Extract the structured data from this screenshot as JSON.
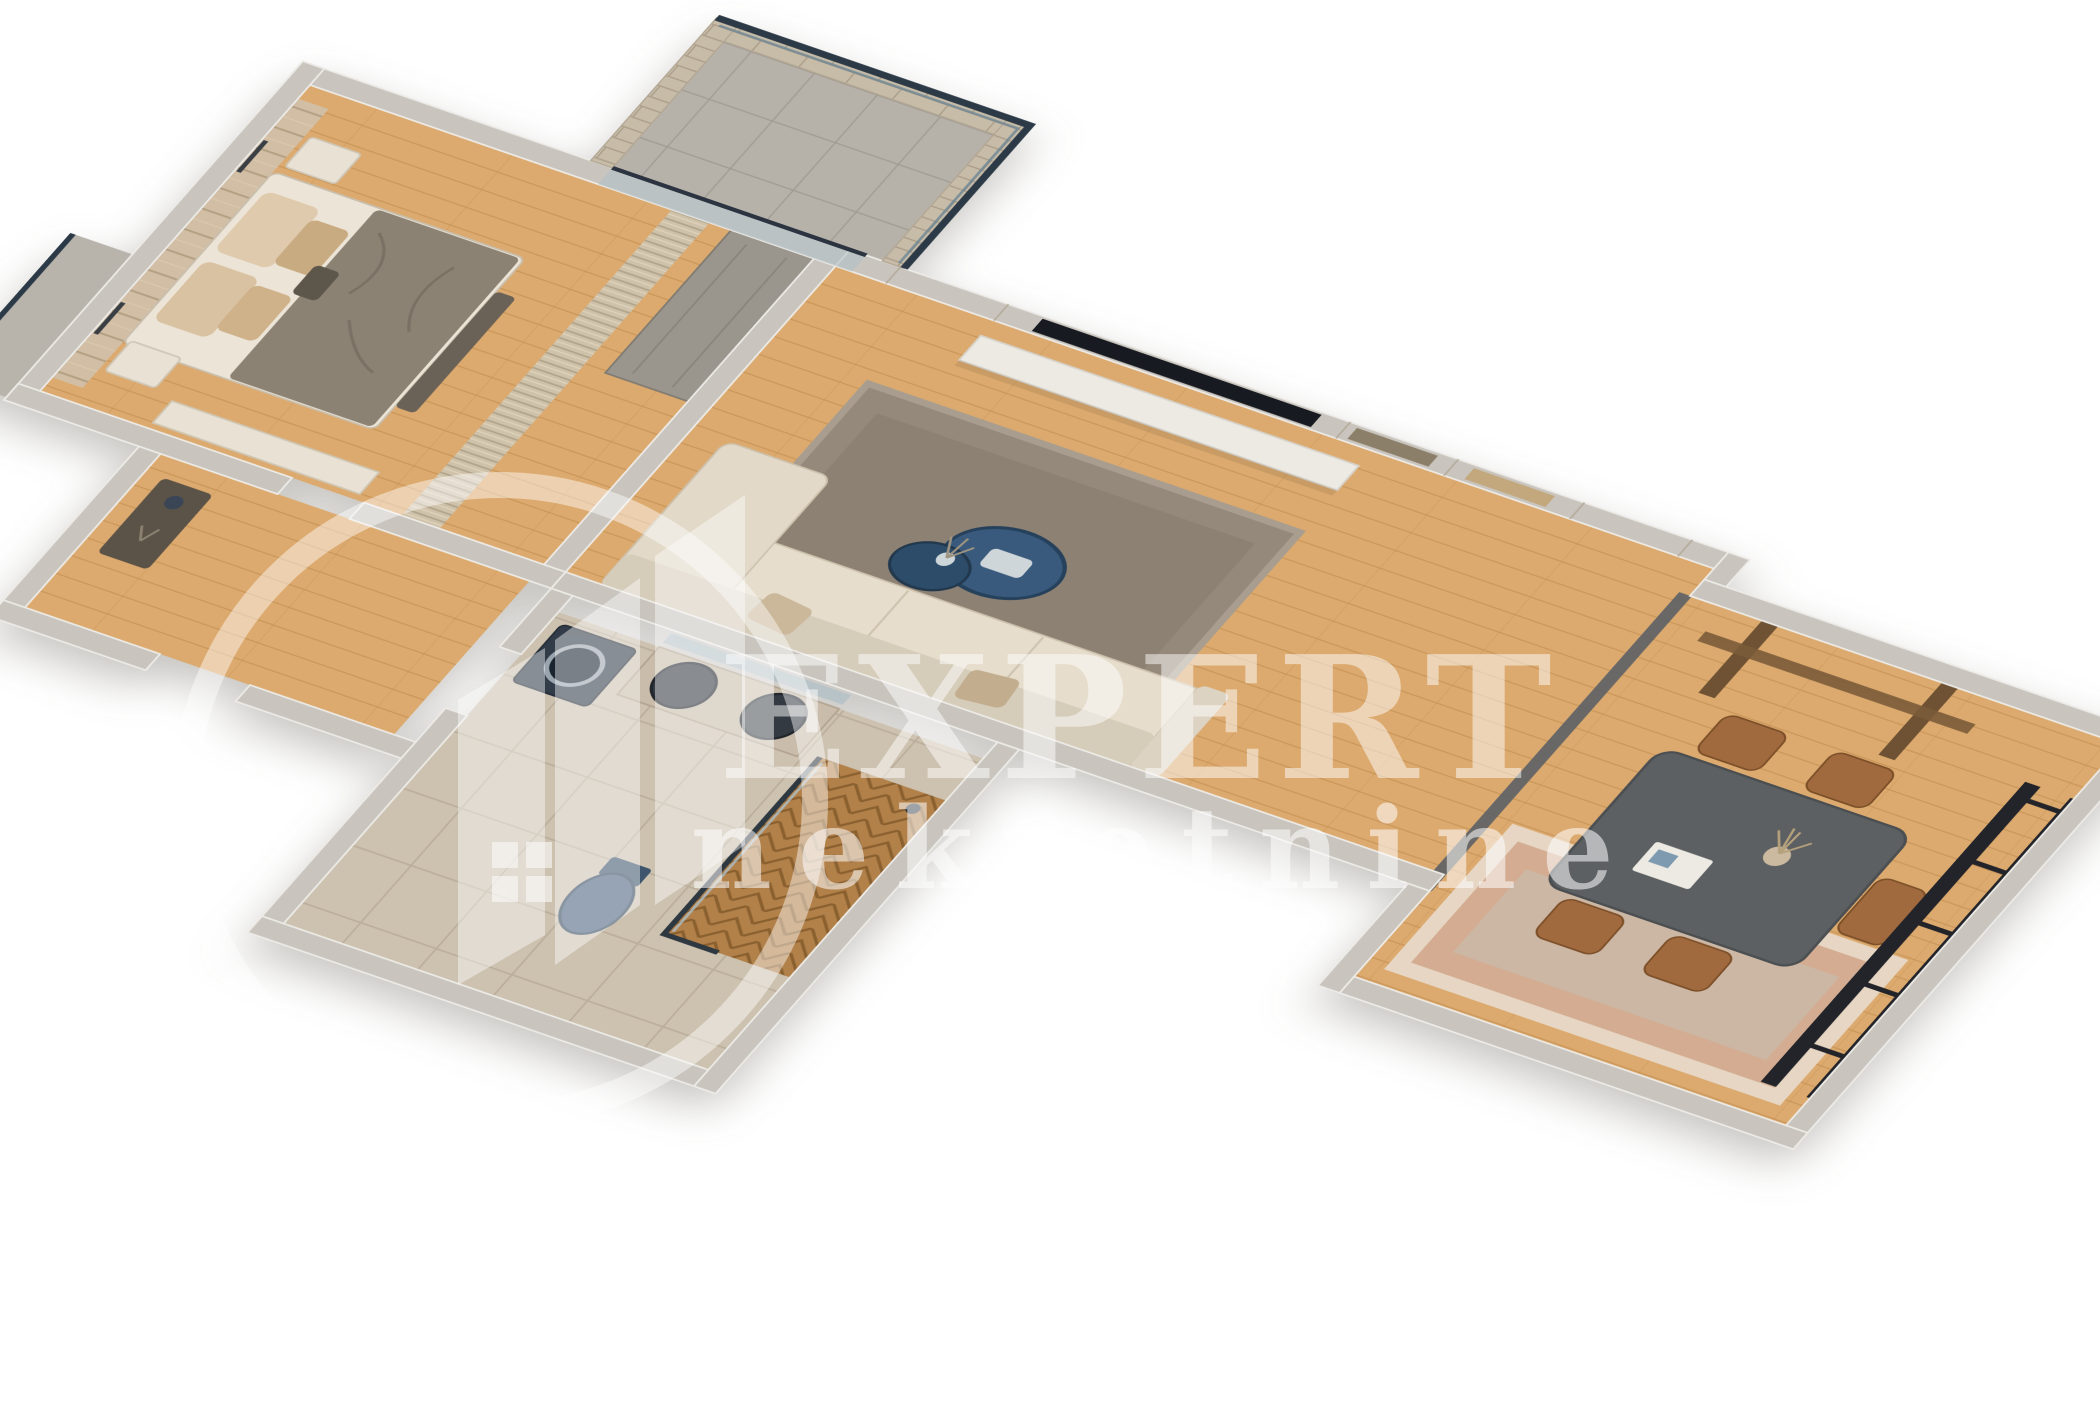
{
  "scene": {
    "kind": "3d-apartment-floor-plan-render",
    "background": "#ffffff",
    "watermark": {
      "brand": "EXPERT",
      "tagline": "nekretnine",
      "logo": "circle-ring-with-buildings-and-window-icon",
      "color": "#ffffff",
      "opacity": 0.5
    },
    "rooms": [
      {
        "name": "bedroom",
        "floor": "wood",
        "furniture": [
          "double-bed",
          "upholstered-headboard",
          "pillows",
          "nightstand-top",
          "nightstand-bottom",
          "wall-lamps",
          "bench",
          "credenza",
          "pleated-curtain",
          "wardrobe"
        ]
      },
      {
        "name": "balcony",
        "floor": "stone",
        "features": [
          "brick-parapet",
          "glass-railing",
          "balcony-door"
        ]
      },
      {
        "name": "living-room",
        "floor": "wood",
        "furniture": [
          "paneled-tv-wall",
          "tv",
          "floating-console",
          "area-rug",
          "coffee-table-duo",
          "vase",
          "corner-sofa",
          "throw-pillows"
        ]
      },
      {
        "name": "dining-area",
        "floor": "wood",
        "furniture": [
          "dining-table",
          "wooden-chairs",
          "dried-plant-vase",
          "magazine",
          "striped-rug",
          "wall-beams",
          "metal-grid-partition",
          "floor-track"
        ]
      },
      {
        "name": "hallway",
        "floor": "wood",
        "furniture": [
          "console-table",
          "decor-bowl"
        ]
      },
      {
        "name": "bathroom",
        "floor": "tile",
        "furniture": [
          "washing-machine",
          "vanity-two-basins",
          "mirror",
          "wall-hung-toilet",
          "walk-in-shower",
          "herringbone-shower-floor",
          "glass-shower-screen"
        ]
      }
    ],
    "palette": {
      "wall": "#c9c5be",
      "wall_edge": "#edebe7",
      "wood_floor": "#dcaa6e",
      "tile_floor": "#cdc2b0",
      "balcony_floor": "#b6b1a9",
      "brick": "#c7bca8",
      "glass_rail": "#2c3a47",
      "rug_living": "#95897b",
      "rug_dining_outer": "#e6d6c3",
      "rug_dining_band": "#d3ac91",
      "sofa": "#e2d9c8",
      "coffee_table_blue": "#395a7c",
      "dining_table": "#5d6062",
      "chair_wood": "#a06a3e",
      "tv": "#171a20",
      "washer": "#323c48",
      "toilet": "#4a637f",
      "shower_wood": "#b28049",
      "blanket": "#8b8274",
      "pillow": "#dfcaad",
      "curtain": "#cfc2ab",
      "headboard": "#d1bea4"
    }
  }
}
